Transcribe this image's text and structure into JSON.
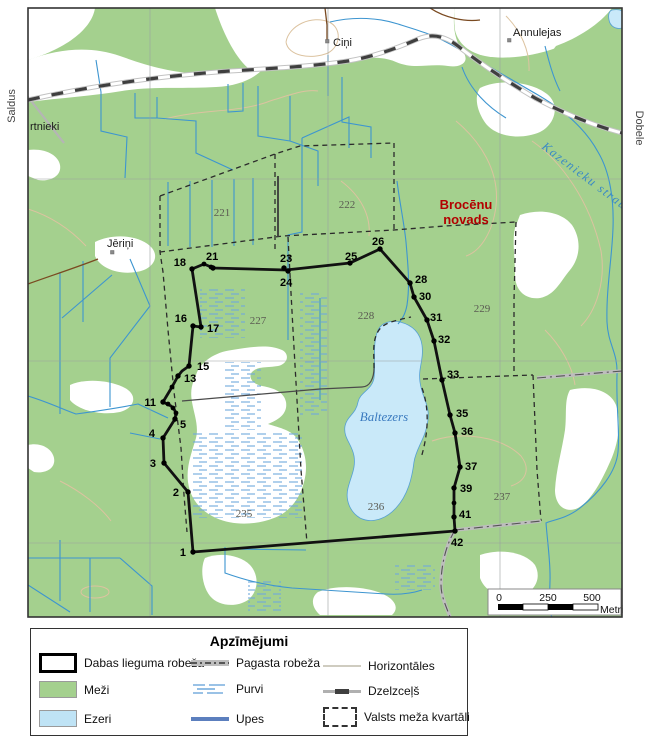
{
  "map": {
    "margin_labels": {
      "left": "Saldus",
      "right": "Dobele"
    },
    "places": {
      "cini": "Ciņi",
      "annulejas": "Annulejas",
      "vartnieki": "rtnieki",
      "jerini": "Jēriņi"
    },
    "water_labels": {
      "lake": "Baltezers",
      "stream": "Kazenieku strauts"
    },
    "district": {
      "line1": "Brocēnu",
      "line2": "novads"
    },
    "quarters": {
      "221": "221",
      "222": "222",
      "227": "227",
      "228": "228",
      "229": "229",
      "235": "235",
      "236": "236",
      "237": "237"
    },
    "points": {
      "1": "1",
      "2": "2",
      "3": "3",
      "4": "4",
      "5": "5",
      "11": "11",
      "13": "13",
      "15": "15",
      "16": "16",
      "17": "17",
      "18": "18",
      "21": "21",
      "23": "23",
      "24": "24",
      "25": "25",
      "26": "26",
      "28": "28",
      "30": "30",
      "31": "31",
      "32": "32",
      "33": "33",
      "35": "35",
      "36": "36",
      "37": "37",
      "39": "39",
      "41": "41",
      "42": "42"
    },
    "scalebar": {
      "t0": "0",
      "t250": "250",
      "t500": "500",
      "unit": "Metri"
    }
  },
  "legend": {
    "title": "Apzīmējumi",
    "items": {
      "dabas": "Dabas lieguma robeža",
      "mezi": "Meži",
      "ezeri": "Ezeri",
      "pagasta": "Pagasta robeža",
      "purvi": "Purvi",
      "upes": "Upes",
      "horizontales": "Horizontāles",
      "dzelzcels": "Dzelzceļš",
      "kvartali": "Valsts meža kvartāli"
    }
  },
  "colors": {
    "forest": "#a4d08e",
    "lake": "#c9e9f9",
    "stream": "#3d95d0",
    "marsh_dash": "#6fa8dc",
    "contour": "#dcc3a0",
    "district_red": "#b30000",
    "boundary": "#111111",
    "railway_dash": "#3f3f3f"
  }
}
